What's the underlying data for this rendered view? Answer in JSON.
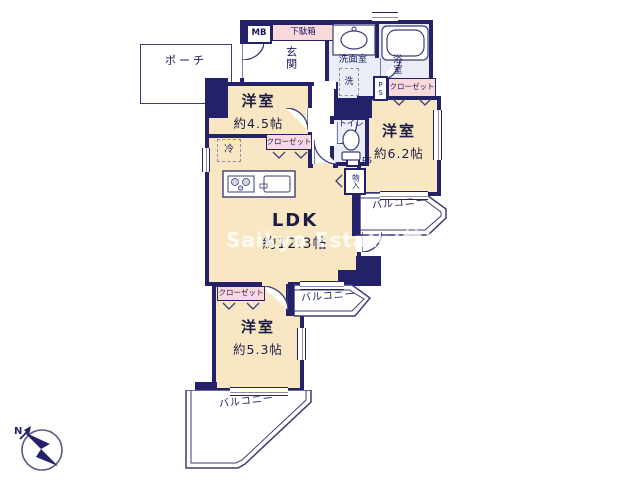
{
  "watermark": "Saikyo Estate(株)",
  "compass": {
    "north": "N"
  },
  "labels": {
    "porch": "ポーチ",
    "mb": "MB",
    "shoe_cabinet": "下駄箱",
    "entrance": "玄関",
    "washroom": "洗面室",
    "bathroom": "浴室",
    "washer": "洗",
    "ps": "PS",
    "closet": "クローゼット",
    "toilet": "トイレ",
    "storage": "物入",
    "fridge": "冷",
    "balcony": "バルコニー"
  },
  "rooms": {
    "western1": {
      "name": "洋室",
      "size": "約4.5帖"
    },
    "western2": {
      "name": "洋室",
      "size": "約6.2帖"
    },
    "western3": {
      "name": "洋室",
      "size": "約5.3帖"
    },
    "ldk": {
      "name": "LDK",
      "size": "約12.3帖"
    }
  },
  "colors": {
    "wall": "#232268",
    "room_fill": "#f9e7c3",
    "wet_fill": "#e8edf6",
    "label_pink": "#f9d9da"
  }
}
